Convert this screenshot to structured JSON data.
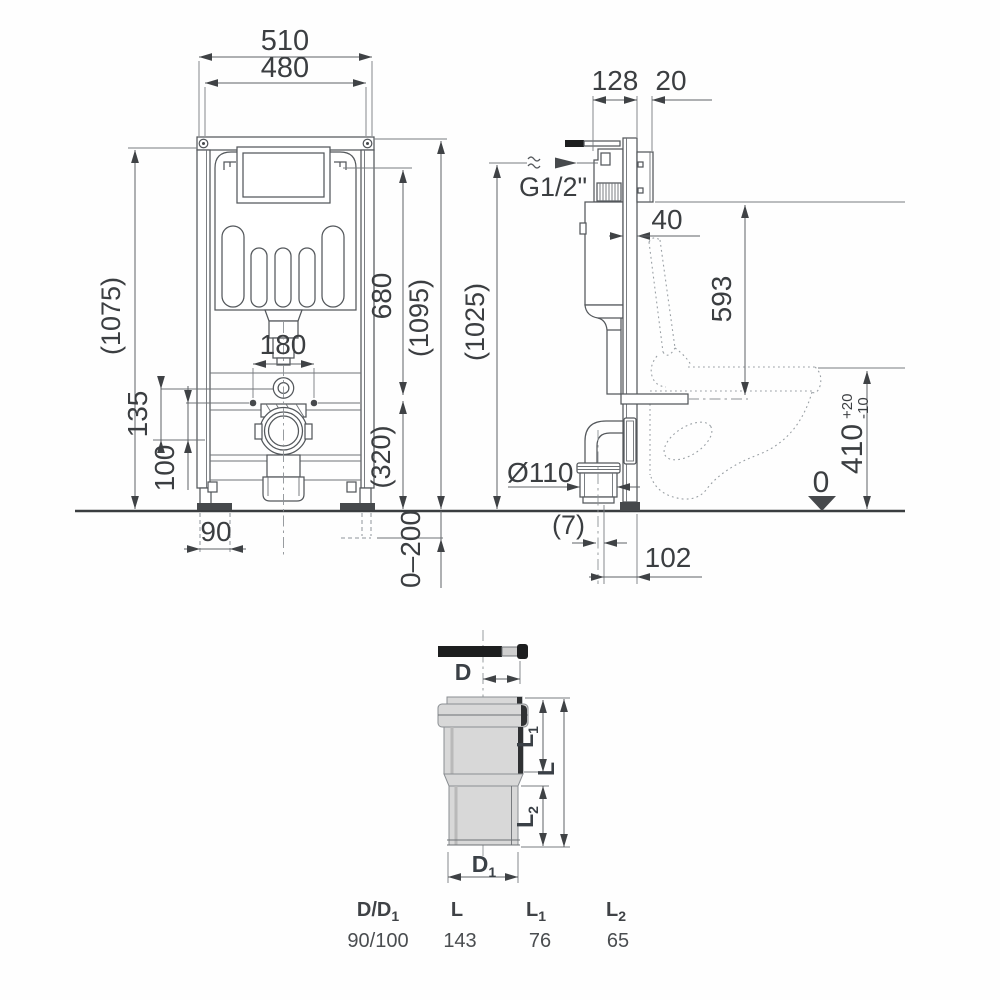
{
  "front_view": {
    "width_outer": "510",
    "width_inner": "480",
    "height_frame": "(1075)",
    "height_flush_plate": "680",
    "height_total": "(1095)",
    "bolt_spacing": "180",
    "flush_to_waste": "135",
    "waste_offset": "100",
    "lower_section": "(320)",
    "foot_width": "90",
    "floor_adjust": "0–200"
  },
  "side_view": {
    "frame_depth": "128",
    "wall_panel": "20",
    "supply_thread": "G1/2\"",
    "profile_depth": "40",
    "spigot_height": "593",
    "install_height": "(1025)",
    "outlet_diameter": "Ø110",
    "outlet_offset": "(7)",
    "outlet_to_wall": "102",
    "datum_zero": "0",
    "bowl_height": "410",
    "bowl_tol_plus": "+20",
    "bowl_tol_minus": "-10"
  },
  "adapter": {
    "label_d": "D",
    "label_d1_base": "D",
    "label_d1_sub": "1",
    "label_l": "L",
    "label_l1_base": "L",
    "label_l1_sub": "1",
    "label_l2_base": "L",
    "label_l2_sub": "2",
    "table": {
      "headers": [
        {
          "base": "D/D",
          "sub": "1"
        },
        {
          "base": "L",
          "sub": ""
        },
        {
          "base": "L",
          "sub": "1"
        },
        {
          "base": "L",
          "sub": "2"
        }
      ],
      "values": [
        "90/100",
        "143",
        "76",
        "65"
      ]
    }
  },
  "colors": {
    "line": "#54585c",
    "arrow": "#3f4245",
    "fill_light_gray": "#d8d8d8",
    "black": "#1d1e1f"
  }
}
